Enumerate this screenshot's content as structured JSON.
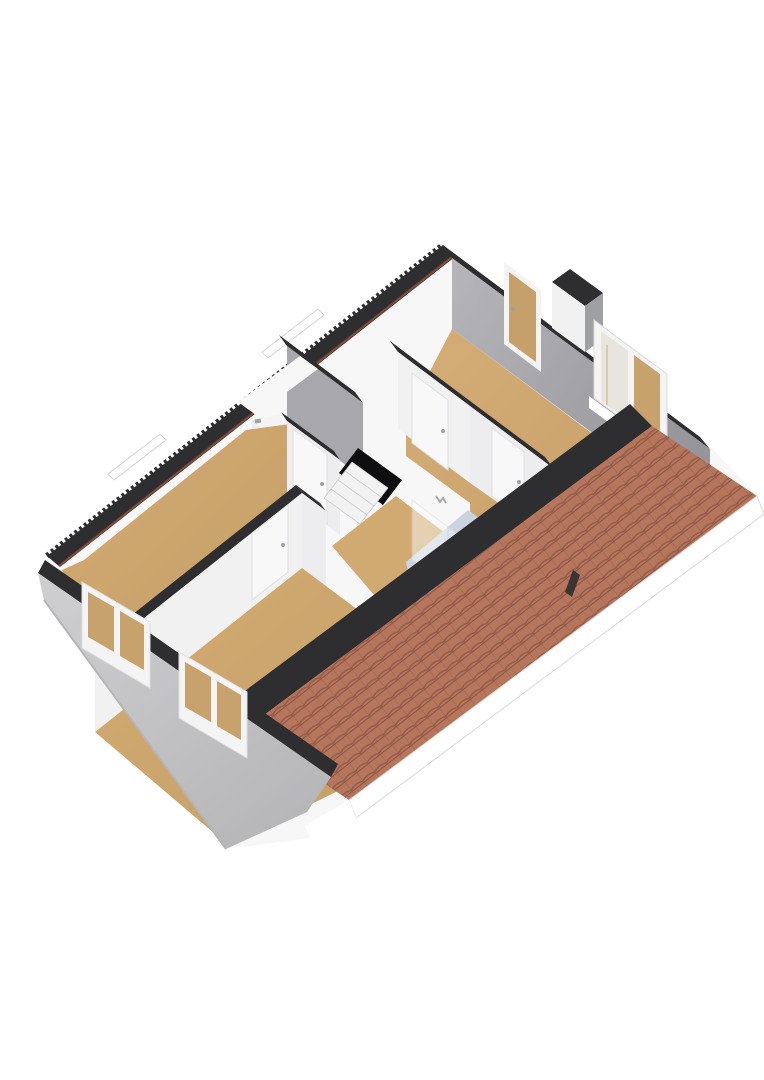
{
  "title": "3D floor plan – attic storey cutaway",
  "scene": {
    "view": "axonometric-3d-floorplan",
    "rooms": [
      {
        "name": "bedroom-upper-left",
        "floor": "carpet-tan"
      },
      {
        "name": "bedroom-lower-left",
        "floor": "carpet-tan"
      },
      {
        "name": "bedroom-large-right",
        "floor": "carpet-tan"
      },
      {
        "name": "landing-with-staircase",
        "floor": "carpet-tan"
      },
      {
        "name": "laundry-closet",
        "floor": "white"
      },
      {
        "name": "bathroom",
        "floor": "blue-vinyl"
      }
    ],
    "fixtures": [
      "washing-machine",
      "staircase-opening",
      "shower-glass-corner",
      "bathtub",
      "vanity-counter",
      "roof-window",
      "chimney",
      "towel-hook"
    ],
    "windows_count": 4,
    "doors_count": 6
  },
  "colors": {
    "bg": "#ffffff",
    "backing_white": "#f7f7f8",
    "cut_dark": "#2e2e31",
    "ridge_brown": "#7e4b38",
    "sliver_white": "#fdfdfd",
    "wall_white": "#f1f1f2",
    "wall_white_dim": "#ededef",
    "wall_gray": "#a8a8ac",
    "wall_gray_dark": "#9fa0a3",
    "end_wall_light": "#b3b3b7",
    "end_wall_deep": "#97979b",
    "gable_light": "#cdcdcf",
    "gable_deep": "#b9b9bc",
    "floor_tan": "#d0aa71",
    "floor_tan_deep": "#c09a62",
    "bath_floor": "#cbd5e0",
    "bath_floor_deep": "#b9c6d4",
    "tile_base": "#b5765c",
    "tile_line": "#8f5545",
    "tile_soft": "#c08a72",
    "fascia_white": "#ffffff",
    "fascia_edge": "#d8d8da",
    "glass_tan": "#c7a26c",
    "wood_door": "#c5a06a",
    "door_white": "#f8f8f9",
    "door_edge": "#dfdfe1",
    "glass_blue": "#d7dee6",
    "appliance_white": "#f4f4f5",
    "appliance_edge": "#e0e0e2",
    "ring_gray": "#c6c6c9",
    "drum_gray": "#a9abaf",
    "hole_black": "#0e0e10",
    "step_white": "#f2f2f3",
    "step_edge": "#c9c9cc",
    "tub_white": "#f6f7f8",
    "tub_inner": "#ebeef0",
    "counter_tan": "#ddb377",
    "counter_deep": "#c9a168",
    "pane_light": "#e8e5de",
    "shadow_line": "#b5b5b8"
  }
}
